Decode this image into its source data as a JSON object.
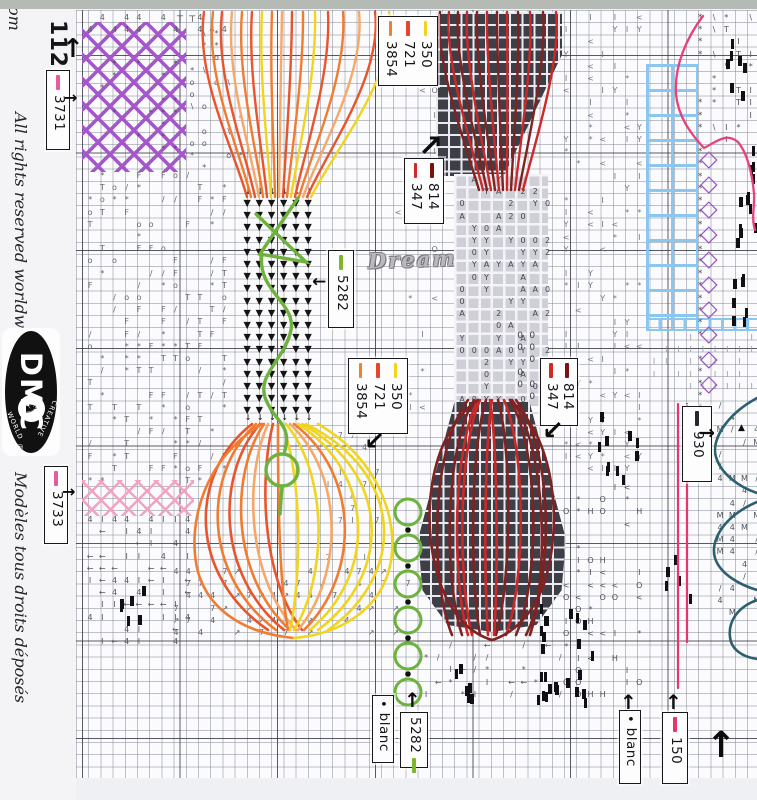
{
  "margin": {
    "corner": "om",
    "rights": "All rights reserved worldwide",
    "deposee": "Modèles tous droits déposés"
  },
  "logo": {
    "brand": "DMC",
    "arc_top": "CREATIVE",
    "arc_bottom": "WORLD",
    "reg": "®",
    "horse": "♞"
  },
  "watermark": {
    "text": "Dream"
  },
  "palette": {
    "r": "#e8542c",
    "o": "#f07c30",
    "l": "#f5a868",
    "y": "#f0d41e",
    "d": "#7f2222",
    "R": "#cc2828",
    "g": "#6cb23c",
    "p": "#e8407c",
    "t": "#2c5f70",
    "pink": "#e8356e",
    "purple": "#9b50c0",
    "blue": "#8ac6ee"
  },
  "labels": [
    {
      "id": "112",
      "x": 40,
      "y": 20,
      "w": 34,
      "h": 58,
      "plain": true,
      "rows": [
        {
          "text": "112"
        }
      ]
    },
    {
      "id": "3731",
      "x": 46,
      "y": 70,
      "w": 24,
      "h": 80,
      "rows": [
        {
          "swatch": "#e85a9e",
          "text": "3731"
        }
      ]
    },
    {
      "id": "350-top",
      "x": 378,
      "y": 16,
      "w": 60,
      "h": 70,
      "rows": [
        {
          "swatch": "#f2d41c",
          "text": "350"
        },
        {
          "swatch": "#e8442c",
          "text": "721"
        },
        {
          "swatch": "#f08030",
          "text": "3854"
        }
      ]
    },
    {
      "id": "814-top",
      "x": 404,
      "y": 158,
      "w": 40,
      "h": 66,
      "rows": [
        {
          "swatch": "#7a1212",
          "text": "814"
        },
        {
          "swatch": "#d42828",
          "text": "347"
        }
      ]
    },
    {
      "id": "5282-mid",
      "x": 328,
      "y": 250,
      "w": 26,
      "h": 78,
      "rows": [
        {
          "swatch": "#7fb52c",
          "text": "5282"
        }
      ]
    },
    {
      "id": "350-mid",
      "x": 348,
      "y": 358,
      "w": 60,
      "h": 76,
      "rows": [
        {
          "swatch": "#f2d41c",
          "text": "350"
        },
        {
          "swatch": "#e8442c",
          "text": "721"
        },
        {
          "swatch": "#f08030",
          "text": "3854"
        }
      ]
    },
    {
      "id": "814-mid",
      "x": 540,
      "y": 358,
      "w": 38,
      "h": 68,
      "rows": [
        {
          "swatch": "#7a1212",
          "text": "814"
        },
        {
          "swatch": "#d42828",
          "text": "347"
        }
      ]
    },
    {
      "id": "930",
      "x": 682,
      "y": 406,
      "w": 30,
      "h": 76,
      "rows": [
        {
          "swatch": "#26262e",
          "text": "930"
        }
      ]
    },
    {
      "id": "3733",
      "x": 44,
      "y": 466,
      "w": 24,
      "h": 78,
      "rows": [
        {
          "swatch": "#e85a9e",
          "text": "3733"
        }
      ]
    },
    {
      "id": "blanc-mid",
      "x": 372,
      "y": 695,
      "w": 22,
      "h": 68,
      "rows": [
        {
          "dot": "•",
          "text": "blanc"
        }
      ]
    },
    {
      "id": "5282-bottom",
      "x": 400,
      "y": 712,
      "w": 28,
      "h": 56,
      "rows": [
        {
          "text": "5282",
          "swatch": "#7fb52c",
          "after": true
        }
      ]
    },
    {
      "id": "blanc-right",
      "x": 619,
      "y": 710,
      "w": 22,
      "h": 74,
      "rows": [
        {
          "dot": "•",
          "text": "blanc"
        }
      ]
    },
    {
      "id": "150",
      "x": 662,
      "y": 712,
      "w": 26,
      "h": 72,
      "rows": [
        {
          "swatch": "#e8356e",
          "text": "150"
        }
      ]
    }
  ],
  "arrows": [
    {
      "g": "↑",
      "x": 62,
      "y": 36,
      "s": 26,
      "w": 600
    },
    {
      "g": "→",
      "x": 64,
      "y": 90,
      "s": 16,
      "w": 700
    },
    {
      "g": "→",
      "x": 62,
      "y": 484,
      "s": 16,
      "w": 700
    },
    {
      "g": "↗",
      "x": 418,
      "y": 132,
      "s": 30,
      "w": 800
    },
    {
      "g": "←",
      "x": 312,
      "y": 274,
      "s": 17,
      "w": 800
    },
    {
      "g": "↙",
      "x": 364,
      "y": 428,
      "s": 25,
      "w": 800
    },
    {
      "g": "↙",
      "x": 542,
      "y": 418,
      "s": 26,
      "w": 800
    },
    {
      "g": "→",
      "x": 699,
      "y": 424,
      "s": 19,
      "w": 800
    },
    {
      "g": "↑",
      "x": 404,
      "y": 690,
      "s": 20,
      "w": 800
    },
    {
      "g": "↑",
      "x": 620,
      "y": 692,
      "s": 20,
      "w": 800
    },
    {
      "g": "↑",
      "x": 665,
      "y": 692,
      "s": 20,
      "w": 800
    },
    {
      "g": "↑",
      "x": 706,
      "y": 728,
      "s": 36,
      "w": 800
    },
    {
      "g": "▲",
      "x": 738,
      "y": 424,
      "s": 9,
      "w": 800
    }
  ],
  "blocks": [
    {
      "x": 436,
      "y": 12,
      "w": 126,
      "h": 164,
      "kind": "dark",
      "clip": "polygon(0 0,100% 0,100% 26%,54% 100%,0 100%)"
    },
    {
      "x": 454,
      "y": 174,
      "w": 94,
      "h": 232,
      "kind": "light"
    },
    {
      "x": 418,
      "y": 400,
      "w": 148,
      "h": 232,
      "kind": "dark",
      "clip": "polygon(25% 0,75% 0,100% 60%,97% 82%,80% 97%,50% 100%,20% 97%,3% 82%,0 60%)"
    },
    {
      "x": 646,
      "y": 64,
      "w": 52,
      "h": 262,
      "kind": "trellis"
    },
    {
      "x": 646,
      "y": 318,
      "w": 111,
      "h": 13,
      "kind": "bluestrip"
    },
    {
      "x": 82,
      "y": 22,
      "w": 104,
      "h": 150,
      "kind": "lattice"
    },
    {
      "x": 82,
      "y": 480,
      "w": 112,
      "h": 36,
      "kind": "pinkx"
    }
  ],
  "regions": [
    {
      "x": 84,
      "y": 12,
      "w": 160,
      "h": 26,
      "g": "4",
      "color": "#5a5a62",
      "d": 0.5,
      "fs": 8
    },
    {
      "x": 186,
      "y": 28,
      "w": 58,
      "h": 146,
      "g": "* \\ o",
      "color": "#5a5a62",
      "d": 0.4,
      "fs": 8
    },
    {
      "x": 96,
      "y": 58,
      "w": 84,
      "h": 104,
      "g": "*",
      "color": "#50505a",
      "d": 0.3,
      "fs": 8
    },
    {
      "x": 84,
      "y": 170,
      "w": 150,
      "h": 312,
      "g": "/ o * T F",
      "color": "#63636e",
      "d": 0.5,
      "fs": 8
    },
    {
      "x": 84,
      "y": 514,
      "w": 112,
      "h": 132,
      "g": "4 ← I",
      "color": "#55555e",
      "d": 0.55,
      "fs": 8
    },
    {
      "x": 170,
      "y": 566,
      "w": 250,
      "h": 78,
      "g": "↗ 7 4",
      "color": "#60606a",
      "d": 0.5,
      "fs": 8
    },
    {
      "x": 322,
      "y": 430,
      "w": 66,
      "h": 138,
      "g": "7 4 I",
      "color": "#70707a",
      "d": 0.28,
      "fs": 8
    },
    {
      "x": 392,
      "y": 12,
      "w": 54,
      "h": 418,
      "g": "< * I O",
      "color": "#70707a",
      "d": 0.2,
      "fs": 8
    },
    {
      "x": 456,
      "y": 174,
      "w": 92,
      "h": 230,
      "g": "Y 0 2 A",
      "color": "#46464e",
      "d": 0.5,
      "fs": 8
    },
    {
      "x": 560,
      "y": 12,
      "w": 86,
      "h": 468,
      "g": "< Y * I",
      "color": "#74747e",
      "d": 0.36,
      "fs": 8
    },
    {
      "x": 694,
      "y": 12,
      "w": 14,
      "h": 398,
      "g": "*",
      "color": "#50505a",
      "d": 0.85,
      "fs": 9
    },
    {
      "x": 708,
      "y": 12,
      "w": 49,
      "h": 138,
      "g": "* T \\ I",
      "color": "#50505a",
      "d": 0.5,
      "fs": 8
    },
    {
      "x": 560,
      "y": 482,
      "w": 88,
      "h": 220,
      "g": "< * I H O",
      "color": "#50505a",
      "d": 0.45,
      "fs": 8
    },
    {
      "x": 420,
      "y": 640,
      "w": 142,
      "h": 66,
      "g": "* ← / I",
      "color": "#5a5a62",
      "d": 0.4,
      "fs": 8
    },
    {
      "x": 714,
      "y": 400,
      "w": 43,
      "h": 218,
      "g": "4 M /",
      "color": "#4a5258",
      "d": 0.5,
      "fs": 8
    },
    {
      "x": 648,
      "y": 332,
      "w": 105,
      "h": 66,
      "g": "I",
      "color": "#9a9aa4",
      "d": 0.6,
      "fs": 8
    },
    {
      "x": 514,
      "y": 330,
      "w": 22,
      "h": 70,
      "g": "0",
      "color": "#3e3e46",
      "d": 0.8,
      "fs": 9
    },
    {
      "x": 448,
      "y": 408,
      "w": 0,
      "h": 0,
      "g": "0",
      "color": "#55555e",
      "d": 0,
      "fs": 8
    },
    {
      "x": 242,
      "y": 186,
      "w": 74,
      "h": 12,
      "g": "↓",
      "color": "#1c1c1c",
      "d": 1,
      "fs": 8
    },
    {
      "x": 242,
      "y": 412,
      "w": 74,
      "h": 12,
      "g": "↓",
      "color": "#1c1c1c",
      "d": 1,
      "fs": 8
    },
    {
      "x": 241,
      "y": 198,
      "w": 73,
      "h": 214,
      "g": "▼",
      "color": "#141414",
      "d": 1,
      "fs": 9.5
    },
    {
      "x": 174,
      "y": 14,
      "w": 28,
      "h": 12,
      "g": "⊤",
      "color": "#111111",
      "d": 1,
      "fs": 9
    }
  ],
  "bars": [
    [
      726,
      36,
      18,
      62,
      7
    ],
    [
      740,
      146,
      14,
      78,
      7
    ],
    [
      732,
      186,
      22,
      150,
      12
    ],
    [
      594,
      402,
      46,
      78,
      10
    ],
    [
      664,
      552,
      26,
      48,
      5
    ],
    [
      446,
      650,
      26,
      54,
      7
    ],
    [
      528,
      650,
      34,
      56,
      8
    ],
    [
      566,
      592,
      26,
      112,
      10
    ],
    [
      110,
      584,
      34,
      38,
      6
    ],
    [
      396,
      18,
      18,
      26,
      3
    ],
    [
      536,
      586,
      20,
      60,
      6
    ]
  ],
  "diamond_chain": {
    "x": 700,
    "y0": 148,
    "step": 25,
    "n": 10,
    "glyph": "◇",
    "size": 23
  },
  "strokes": {
    "left_top_fan": {
      "y0": 12,
      "y1": 197,
      "cx": 296,
      "c1y": 75,
      "c2y": 150,
      "strands": [
        [
          204,
          247,
          "r"
        ],
        [
          213,
          251,
          "o"
        ],
        [
          222,
          255,
          "r"
        ],
        [
          232,
          259,
          "l"
        ],
        [
          242,
          263,
          "o"
        ],
        [
          252,
          267,
          "r"
        ],
        [
          262,
          271,
          "y"
        ],
        [
          272,
          275,
          "o"
        ],
        [
          282,
          279,
          "l"
        ],
        [
          292,
          283,
          "r"
        ],
        [
          303,
          287,
          "o"
        ],
        [
          315,
          291,
          "y"
        ],
        [
          328,
          295,
          "r"
        ],
        [
          343,
          299,
          "o"
        ],
        [
          359,
          303,
          "l"
        ],
        [
          375,
          307,
          "r"
        ],
        [
          389,
          311,
          "y"
        ]
      ]
    },
    "right_top_fan": {
      "y0": 12,
      "y1": 190,
      "cx": 498,
      "c1y": 60,
      "c2y": 150,
      "strands": [
        [
          440,
          479,
          "d"
        ],
        [
          449,
          483,
          "R"
        ],
        [
          458,
          487,
          "d"
        ],
        [
          467,
          491,
          "R"
        ],
        [
          477,
          495,
          "d"
        ],
        [
          487,
          499,
          "R"
        ],
        [
          497,
          503,
          "d"
        ],
        [
          507,
          507,
          "R"
        ],
        [
          518,
          511,
          "d"
        ],
        [
          530,
          515,
          "R"
        ],
        [
          543,
          519,
          "d"
        ],
        [
          556,
          523,
          "R"
        ]
      ]
    },
    "left_bulb": {
      "y0": 424,
      "y1": 630,
      "strands": [
        [
          252,
          188,
          268,
          "r"
        ],
        [
          256,
          202,
          276,
          "o"
        ],
        [
          260,
          216,
          284,
          "r"
        ],
        [
          264,
          230,
          290,
          "o"
        ],
        [
          268,
          245,
          296,
          "l"
        ],
        [
          273,
          260,
          302,
          "r"
        ],
        [
          278,
          278,
          288,
          "o"
        ],
        [
          282,
          302,
          290,
          "y"
        ],
        [
          286,
          328,
          294,
          "y"
        ],
        [
          290,
          344,
          298,
          "l"
        ],
        [
          294,
          360,
          304,
          "o"
        ],
        [
          298,
          376,
          310,
          "y"
        ],
        [
          302,
          392,
          318,
          "y"
        ],
        [
          306,
          406,
          328,
          "y"
        ]
      ]
    },
    "right_bulb": {
      "y0": 400,
      "y1": 635,
      "strands": [
        [
          468,
          430,
          452,
          "d"
        ],
        [
          474,
          444,
          462,
          "d"
        ],
        [
          480,
          458,
          472,
          "R"
        ],
        [
          486,
          470,
          480,
          "d"
        ],
        [
          492,
          484,
          488,
          "R"
        ],
        [
          498,
          512,
          496,
          "d"
        ],
        [
          504,
          526,
          506,
          "R"
        ],
        [
          510,
          540,
          516,
          "d"
        ],
        [
          516,
          554,
          526,
          "d"
        ],
        [
          490,
          498,
          494,
          "R"
        ],
        [
          478,
          452,
          468,
          "R"
        ],
        [
          512,
          548,
          530,
          "d"
        ]
      ]
    },
    "extra": [
      {
        "d": "M478,400 C428,434 418,525 442,588 C454,618 472,634 492,640",
        "c": "d"
      },
      {
        "d": "M510,400 C554,436 564,522 544,584 C532,616 512,634 492,640",
        "c": "d"
      },
      {
        "d": "M262,424 C204,458 186,525 198,572 C210,614 250,634 294,638",
        "c": "o"
      },
      {
        "d": "M318,424 C378,458 400,520 390,566 C380,610 340,634 294,638",
        "c": "y"
      },
      {
        "d": "M703,16 C688,36 674,64 676,94 C678,116 690,133 704,148 C716,142 726,132 738,142 C748,154 752,173 754,193 C755,206 751,217 755,230",
        "c": "p",
        "w": 2.3
      },
      {
        "d": "M757,398 C724,416 711,442 716,457 C721,474 739,487 757,493",
        "c": "t"
      },
      {
        "d": "M757,502 C722,517 710,542 715,558 C720,574 740,585 757,590",
        "c": "t"
      },
      {
        "d": "M757,600 C738,607 728,621 730,637 C731,649 742,657 757,659",
        "c": "t"
      }
    ],
    "green": {
      "vine": [
        "M298,198 L260,254 L306,262 L256,214",
        "M262,254 C256,292 300,304 290,334 C282,362 256,376 266,400 C274,420 290,424 286,446 L284,454",
        "M282,486 L280,514"
      ],
      "vine_circle": [
        282,
        470,
        16
      ],
      "chain": {
        "cx": 408,
        "y0": 512,
        "step": 36,
        "n": 6,
        "r": 13
      }
    },
    "pink_lines": [
      [
        678,
        404,
        284
      ],
      [
        687,
        404,
        238
      ]
    ]
  }
}
